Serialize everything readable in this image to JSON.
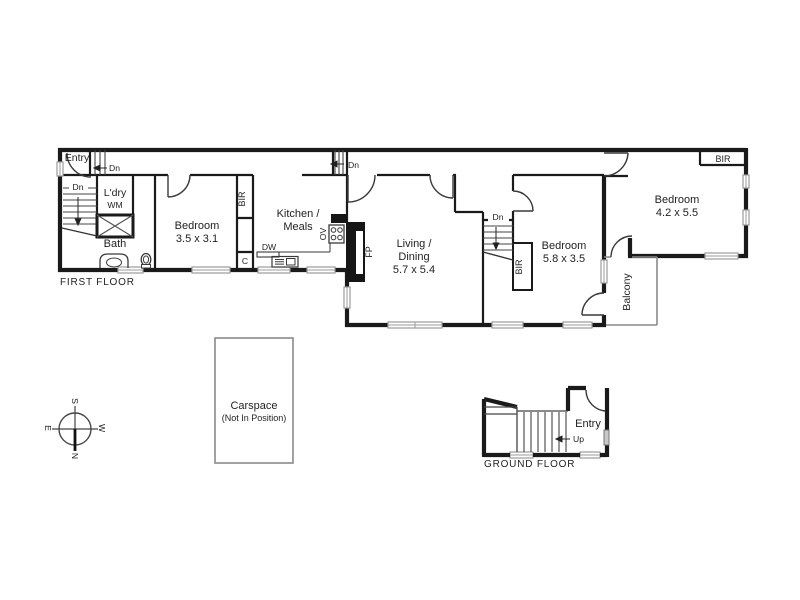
{
  "floor_plan": {
    "first_floor": {
      "section_label": "FIRST FLOOR",
      "entry": "Entry",
      "laundry": "L'dry",
      "washing_machine": "WM",
      "bath": "Bath",
      "bedroom1": {
        "name": "Bedroom",
        "size": "3.5 x 3.1"
      },
      "kitchen": {
        "line1": "Kitchen /",
        "line2": "Meals"
      },
      "living": {
        "line1": "Living /",
        "line2": "Dining",
        "size": "5.7 x 5.4"
      },
      "bedroom2": {
        "name": "Bedroom",
        "size": "5.8 x 3.5"
      },
      "bedroom3": {
        "name": "Bedroom",
        "size": "4.2 x 5.5"
      },
      "balcony": "Balcony"
    },
    "ground_floor": {
      "section_label": "GROUND FLOOR",
      "entry": "Entry"
    },
    "carspace": {
      "line1": "Carspace",
      "line2": "(Not In Position)"
    },
    "fixtures": {
      "built_in_robe": "BIR",
      "cupboard": "C",
      "fireplace": "FP",
      "oven": "OV",
      "dishwasher": "DW"
    },
    "stairs": {
      "down": "Dn",
      "up": "Up"
    },
    "compass": {
      "north": "N",
      "south": "S",
      "east": "E",
      "west": "W"
    },
    "colors": {
      "wall": "#1a1a1a",
      "thin_line": "#333333",
      "window_stroke": "#9b9b9b",
      "light_outline": "#8a8a8a",
      "text": "#1f1f1f"
    }
  }
}
